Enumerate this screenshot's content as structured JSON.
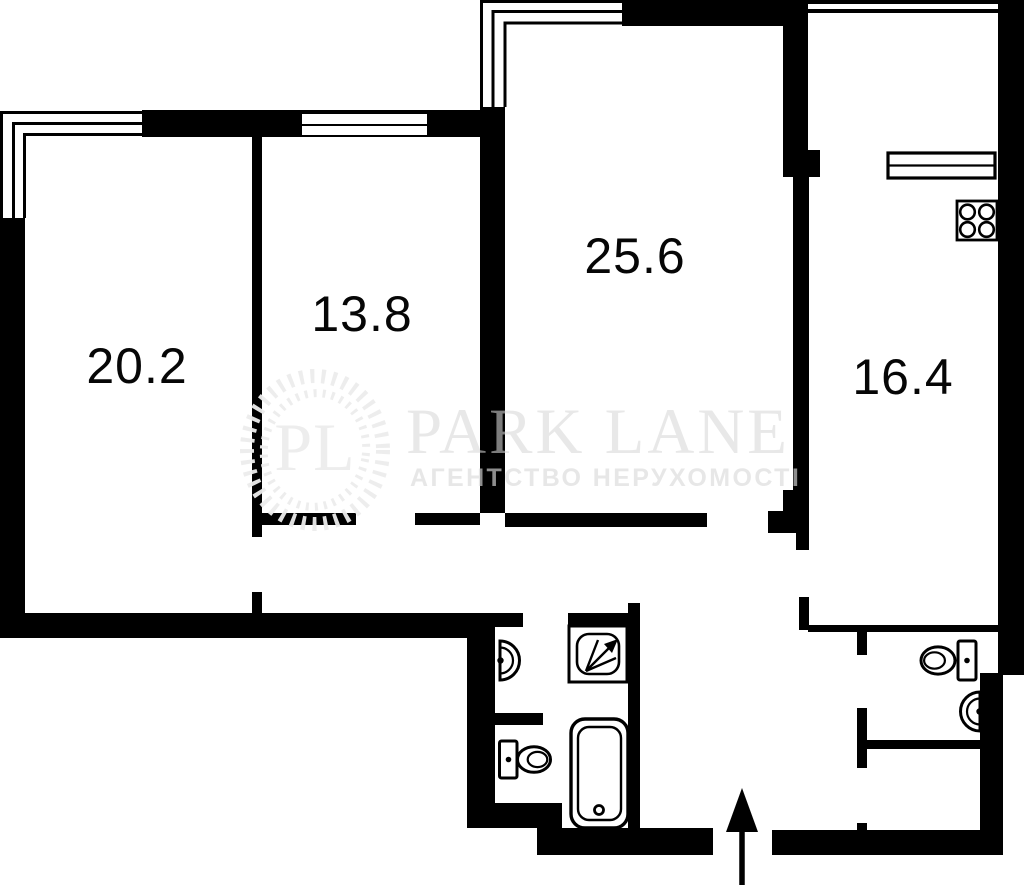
{
  "title": "apartment-floor-plan",
  "rooms": [
    {
      "label": "20.2"
    },
    {
      "label": "13.8"
    },
    {
      "label": "25.6"
    },
    {
      "label": "16.4"
    }
  ],
  "watermark": {
    "monogram": "PL",
    "title": "PARK LANE",
    "subtitle": "АГЕНТСТВО НЕРУХОМОСТІ"
  },
  "fixtures": {
    "bathroom_main": [
      "sink",
      "shower",
      "toilet",
      "bathtub"
    ],
    "kitchen": [
      "stove",
      "window-sill"
    ],
    "bathroom_second": [
      "toilet",
      "sink"
    ],
    "entrance": [
      "entrance-arrow"
    ]
  },
  "colors": {
    "wall": "#000000",
    "background": "#ffffff",
    "watermark_logo": "#ededed",
    "watermark_text": "rgba(215,215,215,0.58)",
    "watermark_subtext": "rgba(218,218,218,0.65)"
  }
}
